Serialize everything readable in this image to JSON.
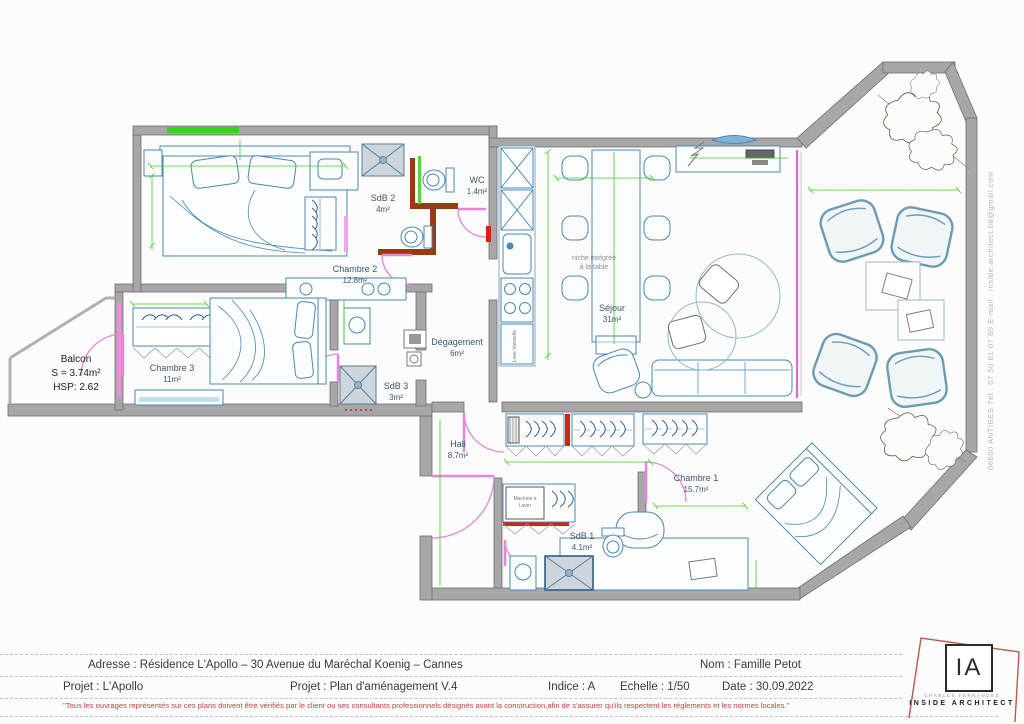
{
  "plan": {
    "balcony": {
      "name": "Balcon",
      "surface": "S = 3.74m²",
      "height": "HSP: 2.62"
    },
    "rooms": {
      "chambre2": {
        "name": "Chambre 2",
        "area": "12.8m²"
      },
      "sdb2": {
        "name": "SdB 2",
        "area": "4m²"
      },
      "wc": {
        "name": "WC",
        "area": "1.4m²"
      },
      "sejour": {
        "name": "Séjour",
        "area": "31m²"
      },
      "chambre3": {
        "name": "Chambre 3",
        "area": "11m²"
      },
      "degagement": {
        "name": "Dégagement",
        "area": "6m²"
      },
      "sdb3": {
        "name": "SdB 3",
        "area": "3m²"
      },
      "hall": {
        "name": "Hall",
        "area": "8.7m²"
      },
      "chambre1": {
        "name": "Chambre 1",
        "area": "15.7m²"
      },
      "sdb1": {
        "name": "SdB 1",
        "area": "4.1m²"
      }
    },
    "annotations": {
      "niche1": "niche intégrée",
      "niche2": "à la table",
      "washer1": "Machine à",
      "washer2": "Laver",
      "dishwasher": "Lave Vaisselle"
    },
    "contact_strip": "06600 ANTIBES    Tél : 07 50 61 07 69    E-mail : inside.architect.06@gmail.com",
    "colors": {
      "wall": "#a7a7a7",
      "accent_wall_brown": "#993a10",
      "accent_wall_red": "#d42313",
      "furniture_blue": "#4b87b5",
      "dimension_green": "#3ecf1e",
      "door_pink": "#e884da"
    }
  },
  "titleblock": {
    "address": "Adresse : Résidence L'Apollo – 30 Avenue du Maréchal Koenig – Cannes",
    "client_name": "Nom : Famille Petot",
    "project": "Projet : L'Apollo",
    "project_doc": "Projet : Plan d'aménagement V.4",
    "index": "Indice : A",
    "scale": "Echelle : 1/50",
    "date": "Date : 30.09.2022",
    "disclaimer": "\"Tous les ouvrages représentés sur ces plans doivent être vérifiés par le client ou ses consultants professionnels désignés avant la construction,afin de s'assurer qu'ils respectent les réglements et les normes locales.\""
  },
  "logo": {
    "monogram": "IA",
    "name": "CHARLES FERNANDEZ",
    "title": "INSIDE ARCHITECT"
  }
}
